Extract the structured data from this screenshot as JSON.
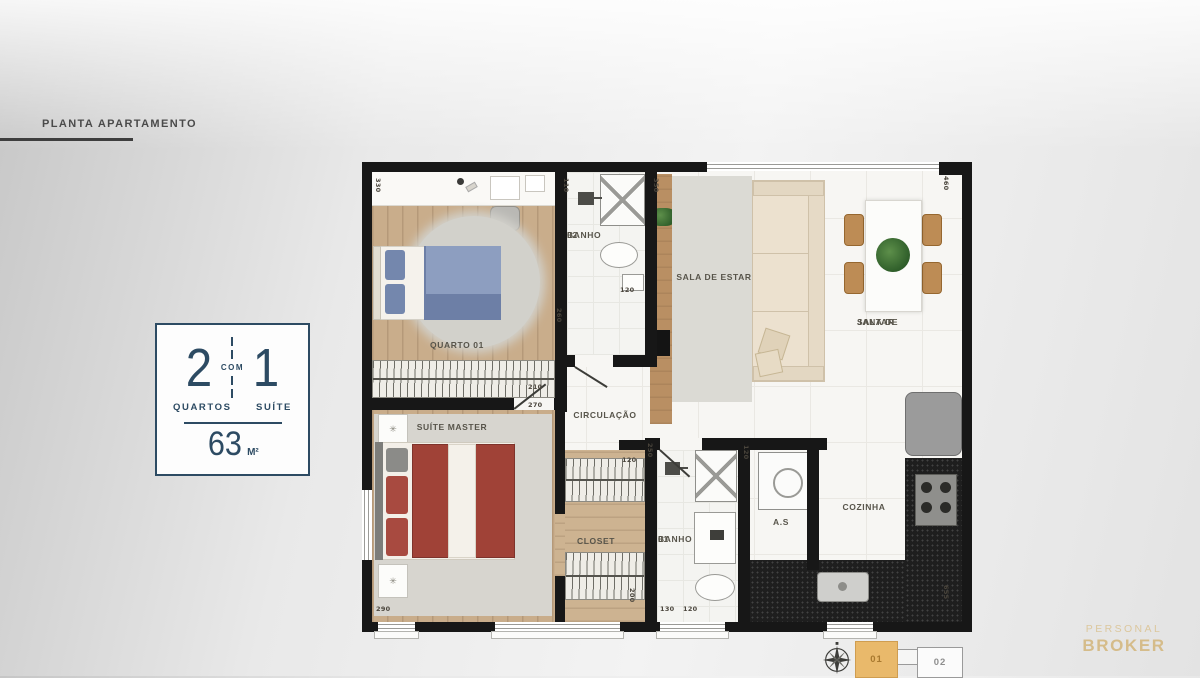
{
  "header": {
    "title": "PLANTA APARTAMENTO"
  },
  "info_box": {
    "left_number": "2",
    "connector": "COM",
    "right_number": "1",
    "left_label": "QUARTOS",
    "right_label": "SUÍTE",
    "area_value": "63",
    "area_unit": "M²"
  },
  "plan": {
    "rooms": {
      "quarto01": "QUARTO 01",
      "banho02": [
        "BANHO",
        "02"
      ],
      "sala_estar": "SALA DE ESTAR",
      "sala_jantar": [
        "SALA DE",
        "JANTAR"
      ],
      "circulacao": "CIRCULAÇÃO",
      "suite": "SUÍTE MASTER",
      "closet": "CLOSET",
      "banho01": [
        "BANHO",
        "01"
      ],
      "area_servico": "A.S",
      "cozinha": "COZINHA"
    },
    "dimensions": [
      {
        "v": "330",
        "x": 12,
        "y": 16,
        "rot": 1
      },
      {
        "v": "110",
        "x": 200,
        "y": 16,
        "rot": 1
      },
      {
        "v": "350",
        "x": 290,
        "y": 16,
        "rot": 1
      },
      {
        "v": "460",
        "x": 580,
        "y": 14,
        "rot": 1
      },
      {
        "v": "120",
        "x": 258,
        "y": 124,
        "rot": 0
      },
      {
        "v": "260",
        "x": 193,
        "y": 146,
        "rot": 1
      },
      {
        "v": "210",
        "x": 166,
        "y": 221,
        "rot": 0
      },
      {
        "v": "270",
        "x": 166,
        "y": 239,
        "rot": 0
      },
      {
        "v": "250",
        "x": 284,
        "y": 281,
        "rot": 1
      },
      {
        "v": "120",
        "x": 260,
        "y": 294,
        "rot": 0
      },
      {
        "v": "120",
        "x": 380,
        "y": 283,
        "rot": 1
      },
      {
        "v": "200",
        "x": 266,
        "y": 426,
        "rot": 1
      },
      {
        "v": "290",
        "x": 14,
        "y": 443,
        "rot": 0
      },
      {
        "v": "130",
        "x": 298,
        "y": 443,
        "rot": 0
      },
      {
        "v": "120",
        "x": 321,
        "y": 443,
        "rot": 0
      },
      {
        "v": "655",
        "x": 580,
        "y": 423,
        "rot": 1
      }
    ]
  },
  "footer": {
    "unit01": "01",
    "unit02": "02",
    "logo_line1": "PERSONAL",
    "logo_line2": "BROKER"
  },
  "colors": {
    "accent_navy": "#2d4b63",
    "unit_highlight": "#e9b96b",
    "logo_tan": "#d5bc8a",
    "wall_black": "#171717",
    "wood_floor": "#c9ad8b"
  }
}
